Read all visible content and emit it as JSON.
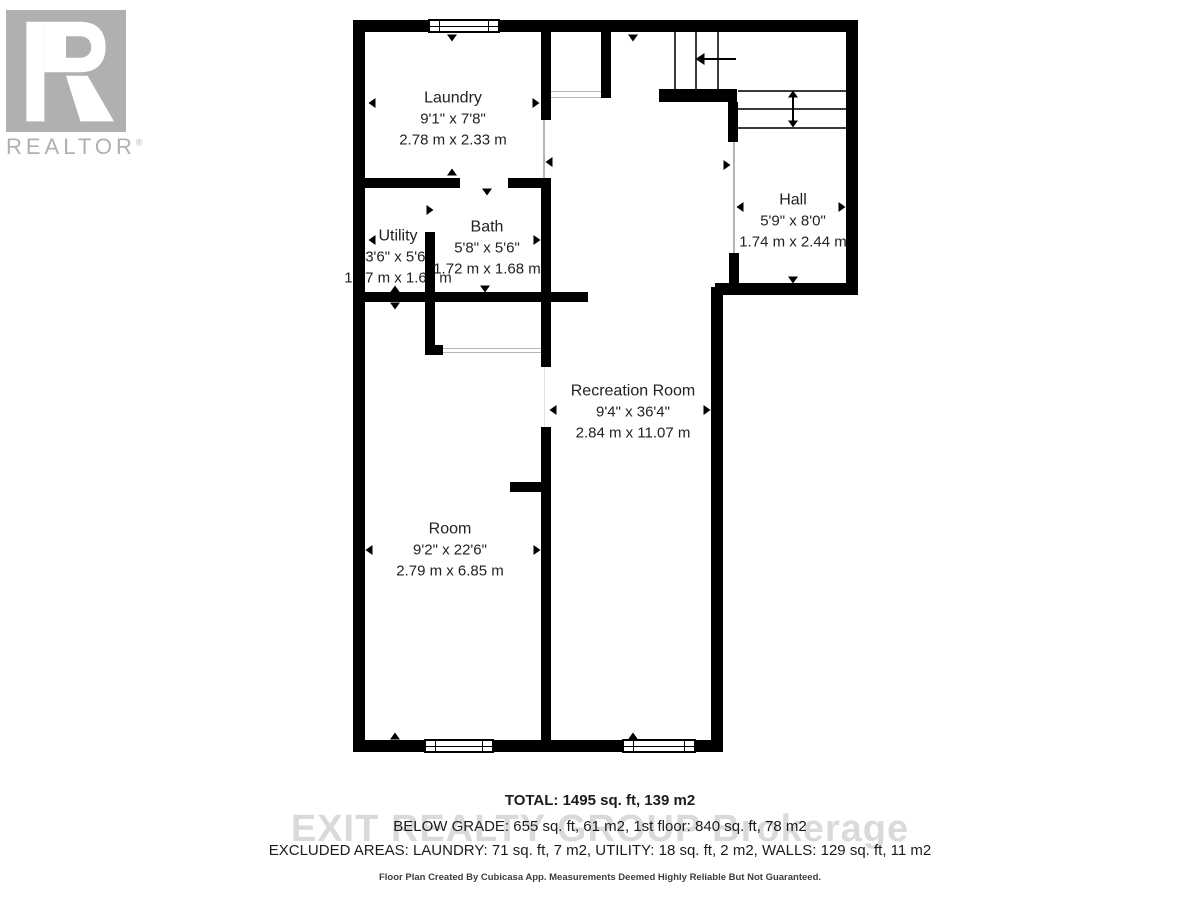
{
  "logo": {
    "letter": "R",
    "wordmark": "REALTOR",
    "registered": "®"
  },
  "rooms": [
    {
      "name": "Laundry",
      "imperial": "9'1\" x 7'8\"",
      "metric": "2.78 m x 2.33 m"
    },
    {
      "name": "Utility",
      "imperial": "3'6\" x 5'6\"",
      "metric": "1.07 m x 1.68 m"
    },
    {
      "name": "Bath",
      "imperial": "5'8\" x 5'6\"",
      "metric": "1.72 m x 1.68 m"
    },
    {
      "name": "Hall",
      "imperial": "5'9\" x 8'0\"",
      "metric": "1.74 m x 2.44 m"
    },
    {
      "name": "Recreation Room",
      "imperial": "9'4\" x 36'4\"",
      "metric": "2.84 m x 11.07 m"
    },
    {
      "name": "Room",
      "imperial": "9'2\" x 22'6\"",
      "metric": "2.79 m x 6.85 m"
    }
  ],
  "summary": {
    "total": "TOTAL: 1495 sq. ft, 139 m2",
    "below_grade": "BELOW GRADE: 655 sq. ft, 61 m2, 1st floor: 840 sq. ft, 78 m2",
    "excluded": "EXCLUDED AREAS: LAUNDRY: 71 sq. ft, 7 m2, UTILITY: 18 sq. ft, 2 m2, WALLS: 129 sq. ft, 11 m2"
  },
  "watermark": "EXIT REALTY GROUP Brokerage",
  "disclaimer": "Floor Plan Created By Cubicasa App. Measurements Deemed Highly Reliable But Not Guaranteed.",
  "colors": {
    "wall": "#000000",
    "label_text": "#222222",
    "logo_gray": "#b1b0b0",
    "watermark_gray": "#dadada"
  }
}
